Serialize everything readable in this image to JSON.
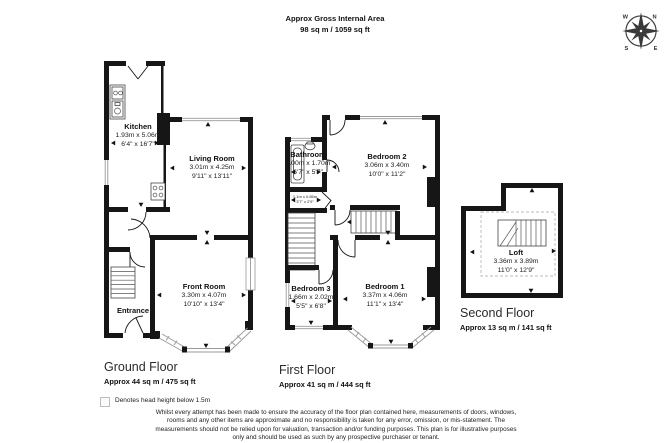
{
  "header": {
    "title": "Approx Gross Internal Area",
    "area_total": "98 sq m / 1059 sq ft"
  },
  "compass": {
    "n": "N",
    "e": "E",
    "s": "S",
    "w": "W"
  },
  "floors": {
    "ground": {
      "label": "Ground Floor",
      "area": "Approx 44 sq m / 475 sq ft",
      "rooms": {
        "kitchen": {
          "name": "Kitchen",
          "metric": "1.93m x 5.06m",
          "imperial": "6'4\" x 16'7\""
        },
        "living": {
          "name": "Living Room",
          "metric": "3.01m x 4.25m",
          "imperial": "9'11\" x 13'11\""
        },
        "front": {
          "name": "Front Room",
          "metric": "3.30m x 4.07m",
          "imperial": "10'10\" x 13'4\""
        },
        "entrance": {
          "name": "Entrance"
        }
      }
    },
    "first": {
      "label": "First Floor",
      "area": "Approx 41 sq m / 444 sq ft",
      "rooms": {
        "bathroom": {
          "name": "Bathroom",
          "metric": "2.00m x 1.70m",
          "imperial": "6'7\" x 5'7\""
        },
        "bedroom2": {
          "name": "Bedroom 2",
          "metric": "3.06m x 3.40m",
          "imperial": "10'0\" x 11'2\""
        },
        "bedroom3": {
          "name": "Bedroom 3",
          "metric": "1.66m x 2.02m",
          "imperial": "5'5\" x 6'8\""
        },
        "bedroom1": {
          "name": "Bedroom 1",
          "metric": "3.37m x 4.06m",
          "imperial": "11'1\" x 13'4\""
        },
        "wc": {
          "metric": "1.1m x 0.85m",
          "imperial": "3'7\" x 2'9\""
        }
      }
    },
    "second": {
      "label": "Second Floor",
      "area": "Approx 13 sq m / 141 sq ft",
      "rooms": {
        "loft": {
          "name": "Loft",
          "metric": "3.36m x 3.89m",
          "imperial": "11'0\" x 12'9\""
        }
      }
    }
  },
  "legend": {
    "text": "Denotes head height below 1.5m"
  },
  "disclaimer": "Whilst every attempt has been made to ensure the accuracy of the floor plan contained here, measurements of doors, windows, rooms and any other items are approximate and no responsibility is taken for any error, omission, or mis-statement. The measurements should not be relied upon for valuation, transaction and/or funding purposes. This plan is for illustrative purposes only and should be used as such by any prospective purchaser or tenant.",
  "colors": {
    "wall": "#161616",
    "window_line": "#999999",
    "head_height_dash": "#b8b8b8"
  }
}
